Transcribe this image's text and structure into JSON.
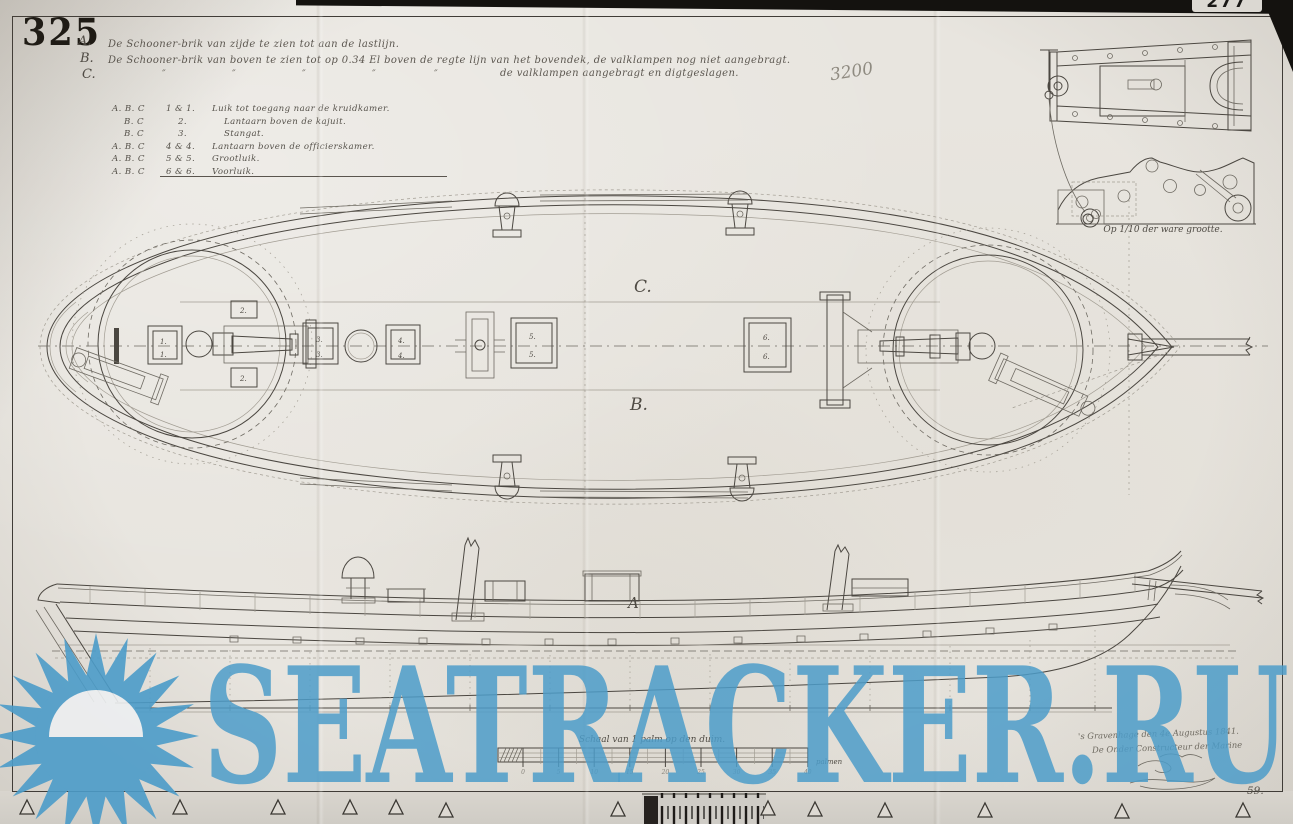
{
  "sheet": {
    "number": "325",
    "archive_tab": "277",
    "pencil_note": "3200",
    "footer_number": "59."
  },
  "title_lines": [
    {
      "label": "A.",
      "text": "De Schooner-brik van zijde te zien tot aan de lastlijn."
    },
    {
      "label": "B.",
      "text": "De Schooner-brik van boven te zien tot op 0.34 El boven de regte lijn van het bovendek, de valklampen nog niet aangebragt."
    },
    {
      "label": "C.",
      "ditto": "″",
      "text": "de valklampen aangebragt en digtgeslagen."
    }
  ],
  "legend": {
    "rows": [
      {
        "letters": "A. B. C",
        "numbers": "1 & 1.",
        "text": "Luik tot toegang naar de kruidkamer."
      },
      {
        "letters": "B. C",
        "numbers": "2.",
        "text": "Lantaarn boven de kajuit."
      },
      {
        "letters": "B. C",
        "numbers": "3.",
        "text": "Stangat."
      },
      {
        "letters": "A. B. C",
        "numbers": "4 & 4.",
        "text": "Lantaarn boven de officierskamer."
      },
      {
        "letters": "A. B. C",
        "numbers": "5 & 5.",
        "text": "Grootluik."
      },
      {
        "letters": "A. B. C",
        "numbers": "6 & 6.",
        "text": "Voorluik."
      }
    ]
  },
  "labels": {
    "plan_top": "C.",
    "plan_bottom": "B.",
    "side": "A",
    "marks": {
      "m1": "1.",
      "m2": "2.",
      "m3": "3.",
      "m4": "4.",
      "m5": "5.",
      "m6": "6."
    }
  },
  "detail_inset": {
    "caption": "Op 1/10 der ware grootte."
  },
  "scale_bar": {
    "caption": "Schaal van 1 palm op den duim.",
    "unit_label": "palmen",
    "ticks": [
      "0",
      "5",
      "10",
      "15",
      "20",
      "25",
      "30",
      "35",
      "40"
    ]
  },
  "colophon": {
    "place_date": "'s Gravenhage den 4e Augustus 1841.",
    "author": "De Onder Constructeur der Marine"
  },
  "watermark": {
    "text": "SEATRACKER.RU",
    "color": "#4C9CC9"
  }
}
